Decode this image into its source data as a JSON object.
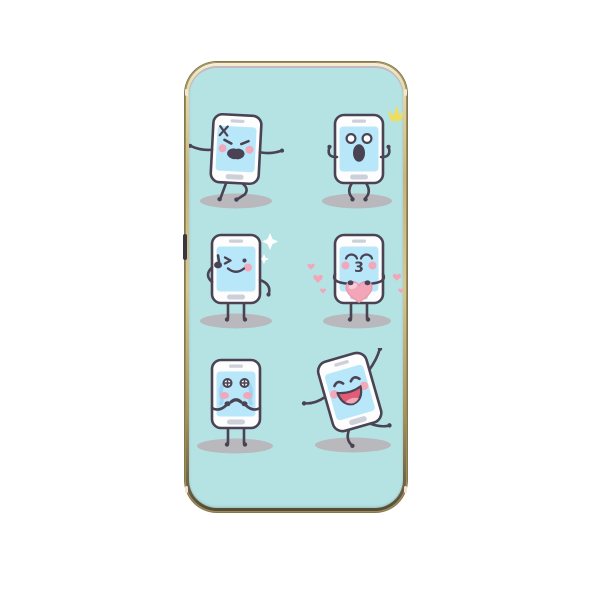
{
  "product": {
    "type": "phone-case-mockup",
    "description": "Phone case with gold metal frame and mint background printed with six cartoon smartphone emoji characters",
    "side_button": "volume-button"
  },
  "characters": [
    {
      "id": "angry-phone",
      "emotion": "angry",
      "features": [
        "anger-vein-mark",
        "slanted-angry-eyes",
        "open-shouting-mouth",
        "arms-out",
        "walking-legs"
      ]
    },
    {
      "id": "shocked-phone",
      "emotion": "surprised",
      "features": [
        "yellow-sparkle",
        "round-white-eyes",
        "oval-open-mouth",
        "hands-raised",
        "bent-knees"
      ]
    },
    {
      "id": "winking-phone",
      "emotion": "winking",
      "features": [
        "thumbs-up",
        "white-diamond-sparkles",
        "smile",
        "one-pink-cheek"
      ]
    },
    {
      "id": "kissing-phone",
      "emotion": "in-love",
      "mouth_glyph": "3",
      "features": [
        "big-pink-heart",
        "floating-hearts",
        "closed-lash-eyes",
        "pink-cheeks"
      ]
    },
    {
      "id": "crying-phone",
      "emotion": "crying",
      "features": [
        "cross-sparkle-eyes",
        "blue-tear-streams",
        "hands-to-mouth",
        "wailing-mouth"
      ]
    },
    {
      "id": "dancing-phone",
      "emotion": "happy",
      "features": [
        "tilted-body",
        "closed-happy-eyes",
        "big-open-laugh",
        "raised-arm",
        "dancing-legs"
      ]
    }
  ],
  "colors": {
    "page_bg": "#ffffff",
    "case_bg": "#b5e3e4",
    "frame_light": "#f6efd6",
    "frame_mid": "#d6c795",
    "frame_dark": "#6a5e43",
    "outline": "#4a4353",
    "body": "#fdfdfe",
    "screen": "#b9e7fa",
    "slot": "#ccd0d8",
    "cheek": "#f0a8ba",
    "shadow": "#b9b8bd",
    "heart": "#f2a6b8",
    "heart_light": "#f8ccd6",
    "tear": "#9fd4f2",
    "sparkle_yellow": "#f0dd5e",
    "sparkle_white": "#ffffff",
    "mouth_red": "#e25c76"
  }
}
